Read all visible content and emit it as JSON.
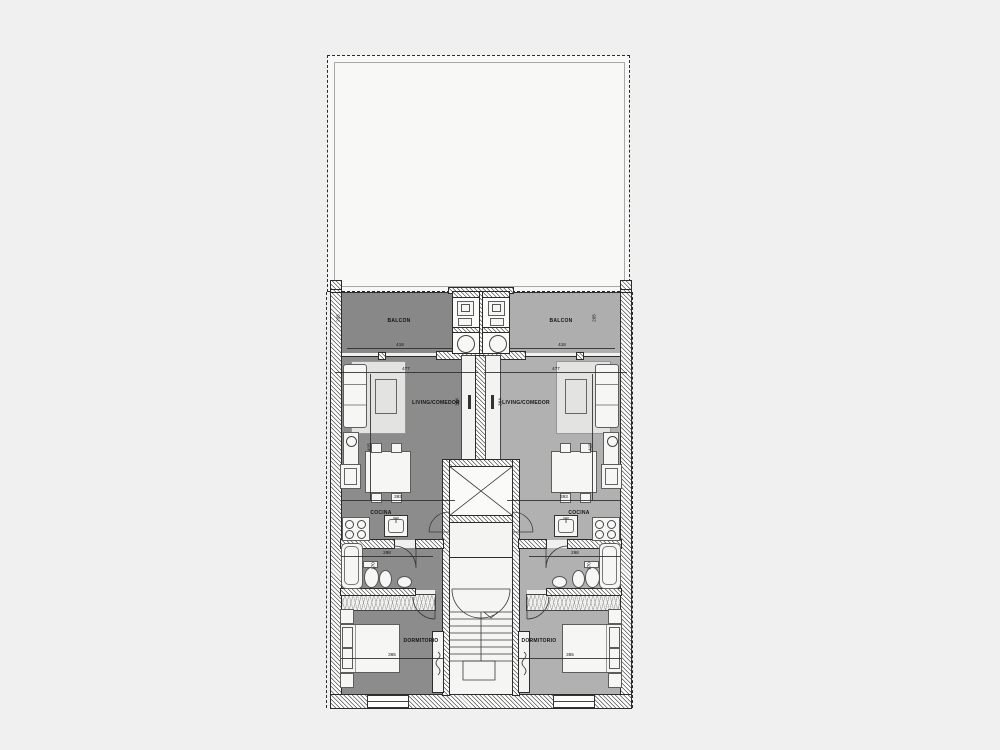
{
  "plan": {
    "rooms": {
      "balcony_left": "BALCON",
      "balcony_right": "BALCON",
      "living_left": "LIVING/COMEDOR",
      "living_right": "LIVING/COMEDOR",
      "kitchen_left": "COCINA",
      "kitchen_right": "COCINA",
      "bedroom_left": "DORMITORIO",
      "bedroom_right": "DORMITORIO"
    },
    "dimensions": {
      "balcony_width": "418",
      "living_width": "477",
      "kitchen_width": "393",
      "bath_width": "298",
      "bedroom_width": "365",
      "balcony_depth": "205",
      "living_depth": "364",
      "living_side_depth": "415",
      "bath_depth": "170"
    },
    "colors": {
      "page_bg": "#f0f0f0",
      "terrace": "#f8f8f7",
      "floor_left": "#8c8c8c",
      "floor_right": "#b1b1b1",
      "balc_left": "#888888",
      "balc_right": "#aeaeae",
      "core": "#f4f4f3",
      "furniture": "#f6f6f5",
      "rug": "#e3e3e1",
      "line": "#2b2b2b"
    }
  }
}
